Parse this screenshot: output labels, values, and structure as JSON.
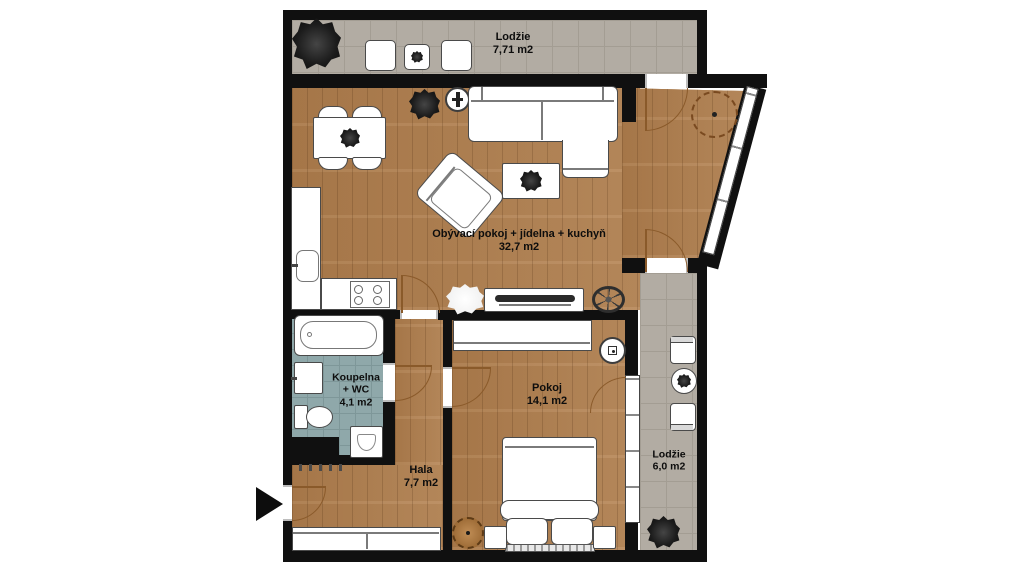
{
  "title": "Floor plan",
  "rooms": {
    "balcony_top": {
      "label": "Lodžie",
      "area": "7,71 m2"
    },
    "living": {
      "label": "Obývací pokoj + jídelna + kuchyň",
      "area": "32,7 m2"
    },
    "bathroom": {
      "line1": "Koupelna",
      "line2": "+ WC",
      "area": "4,1 m2"
    },
    "room": {
      "label": "Pokoj",
      "area": "14,1 m2"
    },
    "hall": {
      "label": "Hala",
      "area": "7,7 m2"
    },
    "balcony_right": {
      "label": "Lodžie",
      "area": "6,0 m2"
    }
  },
  "colors": {
    "wall": "#101010",
    "wood_floor": "#b0804f",
    "balcony_tile": "#b2aca3",
    "bathroom_tile": "#8fa8aa",
    "door_arc": "#8a5a2a"
  },
  "icons": [
    "entrance-arrow-icon",
    "tree-icon",
    "plant-icon",
    "sofa-icon",
    "armchair-icon",
    "coffee-table-icon",
    "dining-table-icon",
    "chair-icon",
    "floor-lamp-icon",
    "tv-stand-icon",
    "fan-wheel-icon",
    "sink-icon",
    "stove-icon",
    "fridge-counter-icon",
    "bathtub-icon",
    "washer-icon",
    "toilet-icon",
    "laundry-basket-icon",
    "coat-hooks-icon",
    "closet-icon",
    "wardrobe-icon",
    "bed-icon",
    "pillow-icon",
    "nightstand-icon",
    "pouf-icon",
    "ceiling-light-icon",
    "balcony-table-icon",
    "window-icon",
    "door-arc-icon"
  ]
}
